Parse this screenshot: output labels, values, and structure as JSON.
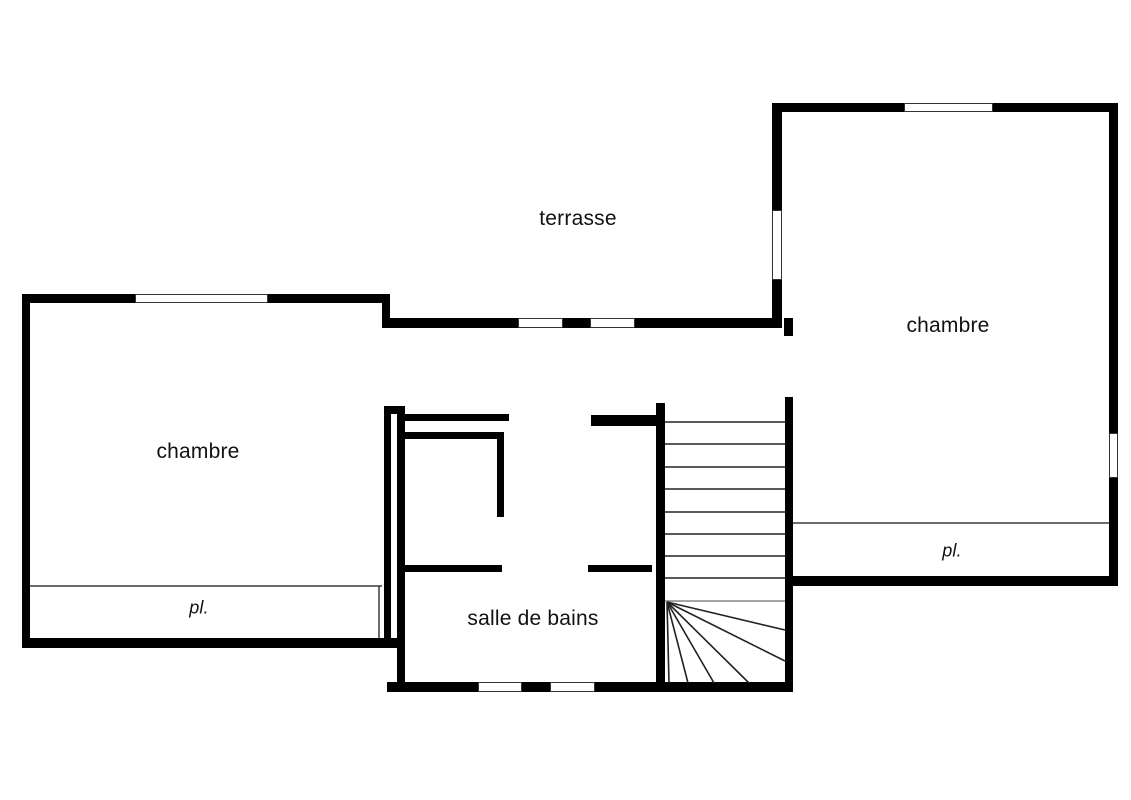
{
  "meta": {
    "type": "floor_plan",
    "description": "Upper floor architectural plan with two bedrooms, bathroom, terrace, closets and a winder staircase",
    "canvas": {
      "width": 1131,
      "height": 800
    },
    "colors": {
      "background": "#ffffff",
      "wall": "#000000",
      "window_fill": "#ffffff",
      "window_stroke": "#333333",
      "thin_line": "#3a3a3a",
      "tread": "#222222",
      "last_tread": "#888888",
      "text": "#111111"
    }
  },
  "rooms": [
    {
      "name": "terrasse"
    },
    {
      "name": "chambre (left)"
    },
    {
      "name": "chambre (right)"
    },
    {
      "name": "salle de bains"
    },
    {
      "name": "placard (left)"
    },
    {
      "name": "placard (right)"
    }
  ],
  "labels": [
    {
      "id": "terrasse-label",
      "text": "terrasse",
      "x": 578,
      "y": 219,
      "size": 21,
      "italic": false
    },
    {
      "id": "chambre-left-label",
      "text": "chambre",
      "x": 198,
      "y": 452,
      "size": 21,
      "italic": false
    },
    {
      "id": "chambre-right-label",
      "text": "chambre",
      "x": 948,
      "y": 326,
      "size": 21,
      "italic": false
    },
    {
      "id": "salle-de-bains-label",
      "text": "salle de bains",
      "x": 533,
      "y": 619,
      "size": 21,
      "italic": false
    },
    {
      "id": "placard-left-label",
      "text": "pl.",
      "x": 199,
      "y": 608,
      "size": 18,
      "italic": true
    },
    {
      "id": "placard-right-label",
      "text": "pl.",
      "x": 952,
      "y": 551,
      "size": 18,
      "italic": true
    }
  ],
  "geometry": {
    "walls": [
      {
        "name": "left-room-top-wall-a",
        "x": 22,
        "y": 294,
        "w": 113,
        "h": 9
      },
      {
        "name": "left-room-top-wall-b",
        "x": 268,
        "y": 294,
        "w": 122,
        "h": 9
      },
      {
        "name": "left-room-left-wall",
        "x": 22,
        "y": 294,
        "w": 8,
        "h": 354
      },
      {
        "name": "left-room-bottom-wall",
        "x": 22,
        "y": 638,
        "w": 376,
        "h": 10
      },
      {
        "name": "left-room-step-wall",
        "x": 382,
        "y": 294,
        "w": 8,
        "h": 34
      },
      {
        "name": "terrasse-bottom-wall-a",
        "x": 382,
        "y": 318,
        "w": 136,
        "h": 10
      },
      {
        "name": "terrasse-bottom-wall-b",
        "x": 563,
        "y": 318,
        "w": 27,
        "h": 10
      },
      {
        "name": "terrasse-bottom-wall-c",
        "x": 635,
        "y": 318,
        "w": 147,
        "h": 10
      },
      {
        "name": "right-room-left-wall-upper",
        "x": 772,
        "y": 103,
        "w": 10,
        "h": 107
      },
      {
        "name": "right-room-left-wall-lower",
        "x": 772,
        "y": 280,
        "w": 10,
        "h": 48
      },
      {
        "name": "right-room-top-wall-a",
        "x": 772,
        "y": 103,
        "w": 132,
        "h": 9
      },
      {
        "name": "right-room-top-wall-b",
        "x": 993,
        "y": 103,
        "w": 125,
        "h": 9
      },
      {
        "name": "right-room-right-wall-upper",
        "x": 1109,
        "y": 103,
        "w": 9,
        "h": 330
      },
      {
        "name": "right-room-right-wall-lower",
        "x": 1109,
        "y": 478,
        "w": 9,
        "h": 108
      },
      {
        "name": "right-room-bottom-wall",
        "x": 785,
        "y": 576,
        "w": 333,
        "h": 10
      },
      {
        "name": "stair-door-jamb",
        "x": 784,
        "y": 318,
        "w": 9,
        "h": 18
      },
      {
        "name": "stair-right-wall",
        "x": 785,
        "y": 397,
        "w": 8,
        "h": 295
      },
      {
        "name": "stair-left-wall",
        "x": 656,
        "y": 403,
        "w": 9,
        "h": 289
      },
      {
        "name": "bath-north-stub-wall",
        "x": 591,
        "y": 415,
        "w": 74,
        "h": 11
      },
      {
        "name": "bath-bottom-wall-a",
        "x": 387,
        "y": 682,
        "w": 91,
        "h": 10
      },
      {
        "name": "bath-bottom-wall-b",
        "x": 522,
        "y": 682,
        "w": 28,
        "h": 10
      },
      {
        "name": "bath-bottom-wall-c",
        "x": 595,
        "y": 682,
        "w": 198,
        "h": 10
      },
      {
        "name": "bath-west-cap-wall",
        "x": 384,
        "y": 406,
        "w": 21,
        "h": 8
      },
      {
        "name": "left-room-right-wall",
        "x": 384,
        "y": 407,
        "w": 7,
        "h": 240
      },
      {
        "name": "bath-left-wall",
        "x": 397,
        "y": 407,
        "w": 8,
        "h": 285
      },
      {
        "name": "bath-north-inner-wall",
        "x": 403,
        "y": 414,
        "w": 106,
        "h": 7
      },
      {
        "name": "bath-fixture-top-wall",
        "x": 402,
        "y": 432,
        "w": 101,
        "h": 7
      },
      {
        "name": "bath-fixture-leg-wall",
        "x": 497,
        "y": 432,
        "w": 7,
        "h": 85
      },
      {
        "name": "bath-mid-wall-left",
        "x": 402,
        "y": 565,
        "w": 100,
        "h": 7
      },
      {
        "name": "bath-mid-wall-right",
        "x": 588,
        "y": 565,
        "w": 64,
        "h": 7
      }
    ],
    "windows": [
      {
        "name": "left-room-top-window",
        "x": 135,
        "y": 294,
        "w": 133,
        "h": 9
      },
      {
        "name": "terrasse-window-a",
        "x": 518,
        "y": 318,
        "w": 45,
        "h": 10
      },
      {
        "name": "terrasse-window-b",
        "x": 590,
        "y": 318,
        "w": 45,
        "h": 10
      },
      {
        "name": "right-room-top-window",
        "x": 904,
        "y": 103,
        "w": 89,
        "h": 9
      },
      {
        "name": "right-room-left-window",
        "x": 772,
        "y": 210,
        "w": 10,
        "h": 70
      },
      {
        "name": "right-room-right-window",
        "x": 1109,
        "y": 433,
        "w": 9,
        "h": 45
      },
      {
        "name": "bath-bottom-window-a",
        "x": 478,
        "y": 682,
        "w": 44,
        "h": 10
      },
      {
        "name": "bath-bottom-window-b",
        "x": 550,
        "y": 682,
        "w": 45,
        "h": 10
      }
    ],
    "closet_lines": [
      {
        "name": "placard-left-front-line",
        "x1": 30,
        "y1": 586,
        "x2": 382,
        "y2": 586
      },
      {
        "name": "placard-left-end-line",
        "x1": 379,
        "y1": 586,
        "x2": 379,
        "y2": 638
      },
      {
        "name": "placard-right-front-line",
        "x1": 793,
        "y1": 523,
        "x2": 1109,
        "y2": 523
      }
    ],
    "stairs": {
      "tread_x_start": 665,
      "tread_x_end": 785,
      "tread_ys": [
        422,
        444,
        467,
        489,
        512,
        534,
        556,
        578
      ],
      "last_tread_y": 601,
      "fan_origin": {
        "x": 667,
        "y": 602
      },
      "fan_ends": [
        {
          "x": 785,
          "y": 630
        },
        {
          "x": 785,
          "y": 661
        },
        {
          "x": 749,
          "y": 683
        },
        {
          "x": 714,
          "y": 683
        },
        {
          "x": 688,
          "y": 683
        },
        {
          "x": 669,
          "y": 683
        }
      ]
    }
  }
}
